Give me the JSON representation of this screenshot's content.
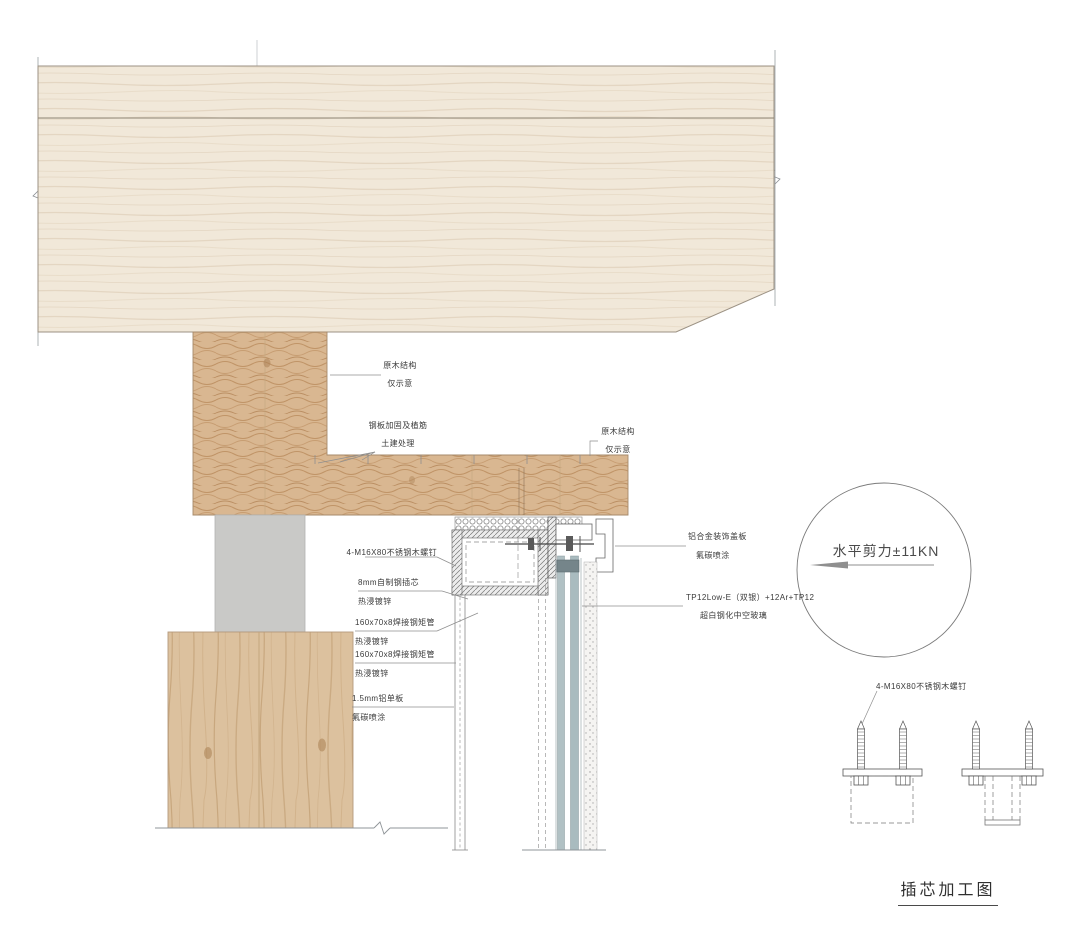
{
  "annotations": {
    "wood_structure_upper": {
      "line1": "原木结构",
      "line2": "仅示意"
    },
    "steel_plate_anchor": {
      "line1": "钢板加固及植筋",
      "line2": "土建处理"
    },
    "wood_structure_right": {
      "line1": "原木结构",
      "line2": "仅示意"
    },
    "wood_screws": {
      "line1": "4-M16X80不锈钢木螺钉"
    },
    "steel_core": {
      "line1": "8mm自制钢插芯",
      "line2": "热浸镀锌"
    },
    "steel_tube_upper": {
      "line1": "160x70x8焊接钢矩管",
      "line2": "热浸镀锌"
    },
    "steel_tube_lower": {
      "line1": "160x70x8焊接钢矩管",
      "line2": "热浸镀锌"
    },
    "aluminum_panel": {
      "line1": "1.5mm铝单板",
      "line2": "氟碳喷涂"
    },
    "cover_plate": {
      "line1": "铝合金装饰盖板",
      "line2": "氟碳喷涂"
    },
    "glazing": {
      "line1": "TP12Low-E（双银）+12Ar+TP12",
      "line2": "超白钢化中空玻璃"
    },
    "shear_force": "水平剪力±11KN",
    "screw_detail": "4-M16X80不锈钢木螺钉",
    "detail_title": "插芯加工图"
  },
  "colors": {
    "wood_light": "#f1e8d9",
    "wood_wavy": "#d9b791",
    "wood_column": "#dcc19e",
    "concrete_gray": "#c9c9c7",
    "glass": "#aebfc3",
    "steel_hatch": "#e8e8e8",
    "line": "#6b6b6b"
  }
}
